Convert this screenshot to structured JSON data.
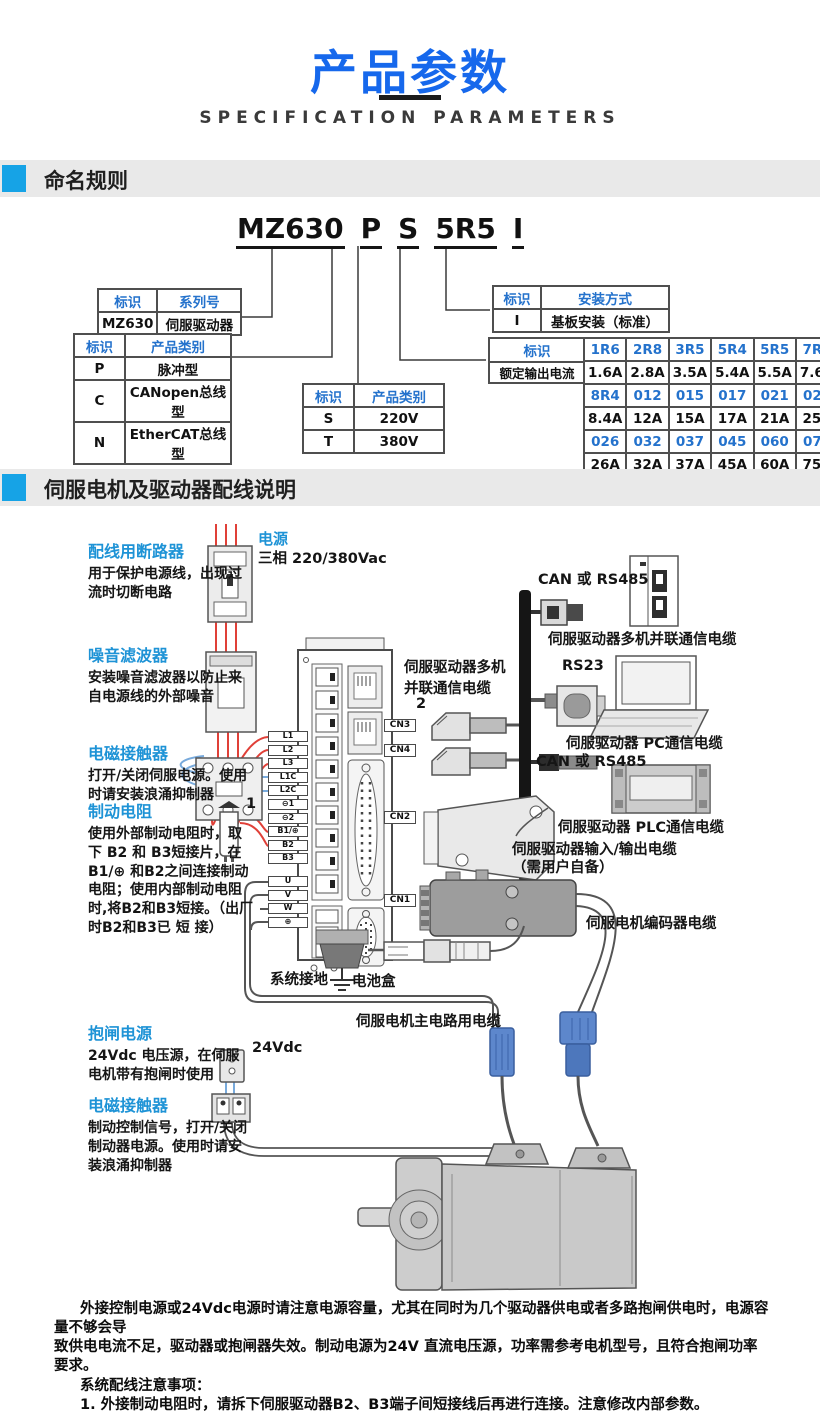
{
  "page": {
    "title": "产品参数",
    "subtitle": "SPECIFICATION PARAMETERS"
  },
  "sections": {
    "naming": "命名规则",
    "wiring": "伺服电机及驱动器配线说明"
  },
  "model_code": {
    "s0": "MZ630",
    "s1": "P",
    "s2": "S",
    "s3": "5R5",
    "s4": "I"
  },
  "naming": {
    "series_table": {
      "h0": "标识",
      "h1": "系列号",
      "r0c0": "MZ630",
      "r0c1": "伺服驱动器"
    },
    "type_table": {
      "h0": "标识",
      "h1": "产品类别",
      "rows": [
        [
          "P",
          "脉冲型"
        ],
        [
          "C",
          "CANopen总线型"
        ],
        [
          "N",
          "EtherCAT总线型"
        ]
      ]
    },
    "voltage_table": {
      "h0": "标识",
      "h1": "产品类别",
      "rows": [
        [
          "S",
          "220V"
        ],
        [
          "T",
          "380V"
        ]
      ]
    },
    "mount_table": {
      "h0": "标识",
      "h1": "安装方式",
      "r0c0": "I",
      "r0c1": "基板安装（标准）"
    },
    "current_table": {
      "h": "标识",
      "label": "额定输出电流",
      "grid": [
        [
          "1R6",
          "2R8",
          "3R5",
          "5R4",
          "5R5",
          "7R6"
        ],
        [
          "1.6A",
          "2.8A",
          "3.5A",
          "5.4A",
          "5.5A",
          "7.6A"
        ],
        [
          "8R4",
          "012",
          "015",
          "017",
          "021",
          "025"
        ],
        [
          "8.4A",
          "12A",
          "15A",
          "17A",
          "21A",
          "25A"
        ],
        [
          "026",
          "032",
          "037",
          "045",
          "060",
          "075"
        ],
        [
          "26A",
          "32A",
          "37A",
          "45A",
          "60A",
          "75A"
        ]
      ]
    }
  },
  "wiring": {
    "power": {
      "title": "电源",
      "body": "三相 220/380Vac"
    },
    "notes": [
      {
        "title": "配线用断路器",
        "body": "用于保护电源线，出现过流时切断电路"
      },
      {
        "title": "噪音滤波器",
        "body": "安装噪音滤波器以防止来自电源线的外部噪音"
      },
      {
        "title": "电磁接触器",
        "body": "打开/关闭伺服电源。使用时请安装浪涌抑制器"
      },
      {
        "title": "制动电阻",
        "body": "使用外部制动电阻时，取下 B2 和 B3短接片，在B1/⊕ 和B2之间连接制动电阻；使用内部制动电阻时,将B2和B3短接。（出厂时B2和B3已 短 接）"
      },
      {
        "title": "抱闸电源",
        "body": "24Vdc 电压源，在伺服电机带有抱闸时使用"
      },
      {
        "title": "电磁接触器",
        "body": "制动控制信号，打开/关闭制动器电源。使用时请安装浪涌抑制器"
      }
    ],
    "labels": {
      "multi_cable_2": "伺服驱动器多机并联通信电缆",
      "num2": "2",
      "num1": "1",
      "can_top": "CAN 或 RS485",
      "multi_cable": "伺服驱动器多机并联通信电缆",
      "rs23": "RS23",
      "pc_cable": "伺服驱动器 PC通信电缆",
      "can_mid": "CAN 或 RS485",
      "plc_cable": "伺服驱动器 PLC通信电缆",
      "io_cable": "伺服驱动器输入/输出电缆",
      "io_cable2": "（需用户自备）",
      "encoder_cable": "伺服电机编码器电缆",
      "ground": "系统接地",
      "battery": "电池盒",
      "main_cable": "伺服电机主电路用电缆",
      "v24": "24Vdc"
    },
    "terminals": [
      "L1",
      "L2",
      "L3",
      "L1C",
      "L2C",
      "⊖1",
      "⊖2",
      "B1/⊕",
      "B2",
      "B3",
      "U",
      "V",
      "W",
      "⊕"
    ],
    "cn": {
      "cn3": "CN3",
      "cn4": "CN4",
      "cn2": "CN2",
      "cn1": "CN1"
    }
  },
  "footer": {
    "lines": [
      "外接控制电源或24Vdc电源时请注意电源容量，尤其在同时为几个驱动器供电或者多路抱闸供电时，电源容量不够会导",
      "致供电电流不足，驱动器或抱闸器失效。制动电源为24V 直流电压源，功率需参考电机型号，且符合抱闸功率要求。",
      "系统配线注意事项：",
      "1. 外接制动电阻时，请拆下伺服驱动器B2、B3端子间短接线后再进行连接。注意修改内部参数。",
      "2. CN3以及CN4为两针脚定义完全一致的通讯接口，可以在两者间任意挑选使用。",
      "3. 在单相220V 配线中，主回路端子为 L1、L2，保留端子请勿进行接线。"
    ]
  }
}
